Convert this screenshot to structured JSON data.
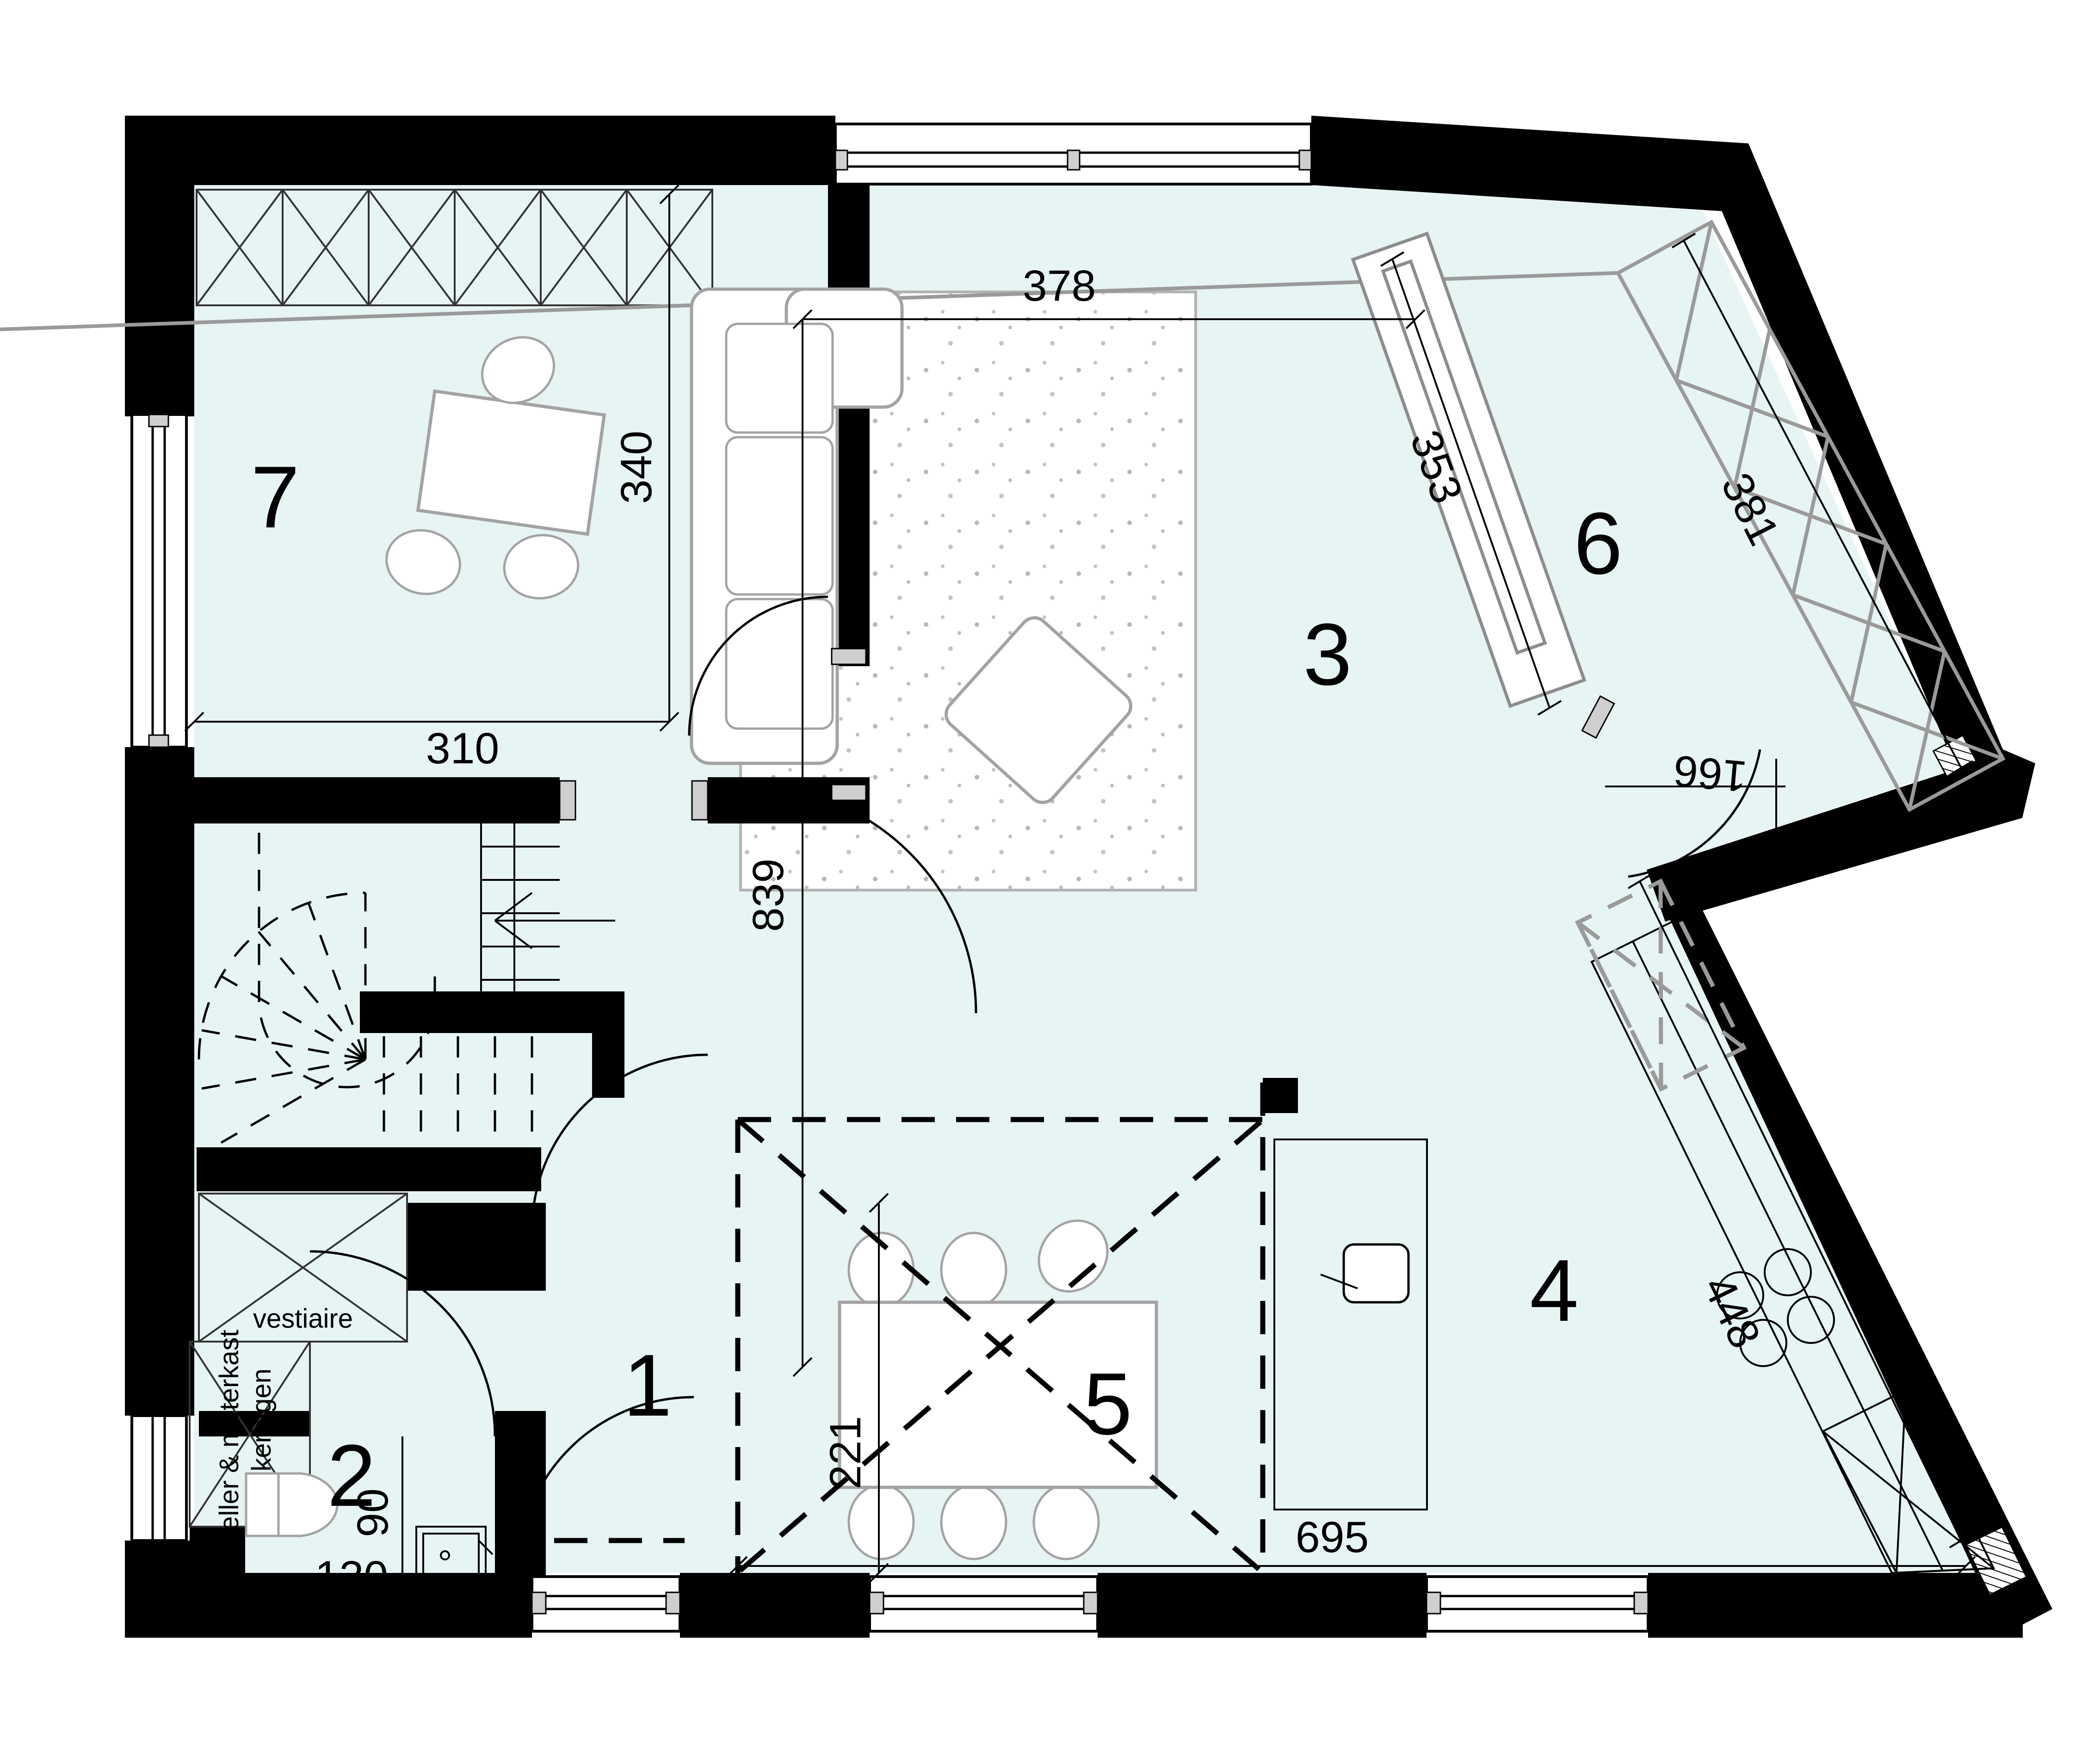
{
  "plan": {
    "rooms": {
      "r1": "1",
      "r2": "2",
      "r3": "3",
      "r4": "4",
      "r5": "5",
      "r6": "6",
      "r7": "7"
    },
    "dims": {
      "d378": "378",
      "d340": "340",
      "d310": "310",
      "d839": "839",
      "d353": "353",
      "d381": "381",
      "d166": "166",
      "d221": "221",
      "d90": "90",
      "d130": "130",
      "d695": "695",
      "d448": "448"
    },
    "labels": {
      "vestiaire": "vestiaire",
      "meter1": "teller & meterkast",
      "meter2": "zekeringen"
    },
    "colors": {
      "floor": "#e6f4f3",
      "wall": "#000000",
      "furniture": "#a3a3a3"
    }
  }
}
